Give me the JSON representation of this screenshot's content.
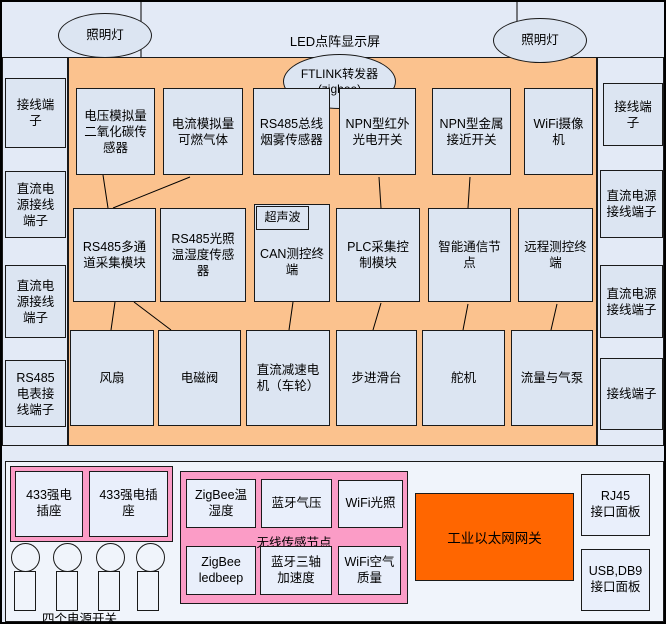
{
  "colors": {
    "canvas": "#e3eaf6",
    "box_fill": "#dce5f2",
    "panel_orange": "#fbc28e",
    "pink": "#fb9cc6",
    "gateway_orange": "#ff6600",
    "bottom_fill": "#f0f4fb"
  },
  "top": {
    "led_display": "LED点阵显示屏",
    "lamp_left": "照明灯",
    "lamp_right": "照明灯",
    "ftlink": "FTLINK转发器\n(zigbee)"
  },
  "left_column": [
    "接线端子",
    "直流电源接线端子",
    "直流电源接线端子",
    "RS485电表接线端子"
  ],
  "right_column": [
    "接线端子",
    "直流电源接线端子",
    "直流电源接线端子",
    "接线端子"
  ],
  "board": {
    "row1": [
      "电压模拟量二氧化碳传感器",
      "电流模拟量可燃气体",
      "RS485总线烟雾传感器",
      "NPN型红外光电开关",
      "NPN型金属接近开关",
      "WiFi摄像机"
    ],
    "row2": [
      "RS485多通道采集模块",
      "RS485光照温湿度传感器",
      "CAN测控终端",
      "PLC采集控制模块",
      "智能通信节点",
      "远程测控终端"
    ],
    "ultrasonic": "超声波",
    "row3": [
      "风扇",
      "电磁阀",
      "直流减速电机（车轮）",
      "步进滑台",
      "舵机",
      "流量与气泵"
    ]
  },
  "bottom": {
    "sockets": [
      "433强电插座",
      "433强电插座"
    ],
    "switches_label": "四个电源开关",
    "wireless": {
      "title": "无线传感节点",
      "top_nodes": [
        "ZigBee温湿度",
        "蓝牙气压",
        "WiFi光照"
      ],
      "bottom_nodes": [
        "ZigBee ledbeep",
        "蓝牙三轴加速度",
        "WiFi空气质量"
      ]
    },
    "gateway": "工业以太网网关",
    "io_panels": [
      "RJ45\n接口面板",
      "USB,DB9\n接口面板"
    ]
  }
}
